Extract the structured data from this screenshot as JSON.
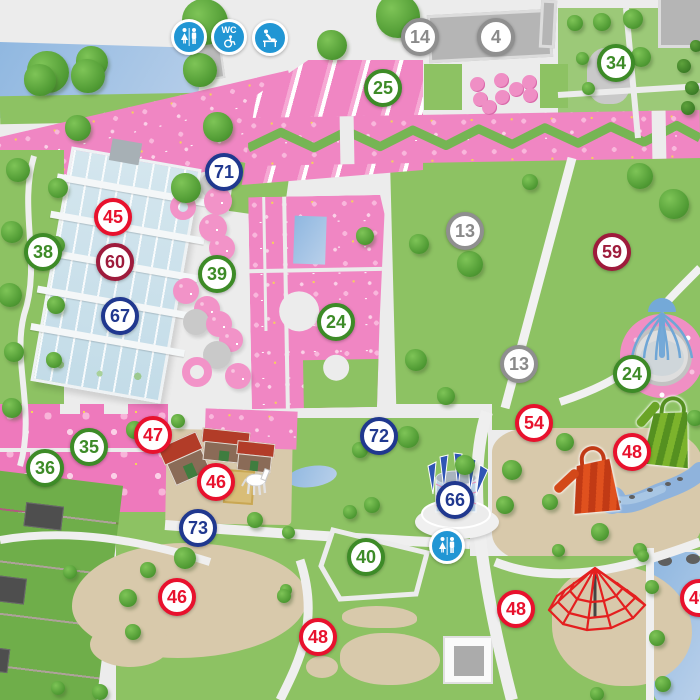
{
  "map": {
    "palette": {
      "path": "#ececec",
      "lawn": "#8dc263",
      "flowerbed": "#f086c3",
      "water": "#8fb7e0",
      "sand": "#d8c9ab",
      "building_gray": "#b5b5b5",
      "greenhouse_glass": "#cfe2eb",
      "marker_green": "#3d8b27",
      "marker_red": "#e8112d",
      "marker_maroon": "#9e1b3c",
      "marker_navy": "#20388f",
      "marker_gray": "#8f8f8f",
      "facility_blue": "#2196d4",
      "zigzag_green": "#76b554",
      "web_red": "#e41f1f"
    },
    "markers": [
      {
        "label": "14",
        "color": "gray",
        "x": 420,
        "y": 37
      },
      {
        "label": "4",
        "color": "gray",
        "x": 496,
        "y": 37
      },
      {
        "label": "34",
        "color": "green",
        "x": 616,
        "y": 63
      },
      {
        "label": "25",
        "color": "green",
        "x": 383,
        "y": 88
      },
      {
        "label": "71",
        "color": "navy",
        "x": 224,
        "y": 172
      },
      {
        "label": "45",
        "color": "red",
        "x": 113,
        "y": 217
      },
      {
        "label": "13",
        "color": "gray",
        "x": 465,
        "y": 231
      },
      {
        "label": "38",
        "color": "green",
        "x": 43,
        "y": 252
      },
      {
        "label": "59",
        "color": "maroon",
        "x": 612,
        "y": 252
      },
      {
        "label": "60",
        "color": "maroon",
        "x": 115,
        "y": 262
      },
      {
        "label": "39",
        "color": "green",
        "x": 217,
        "y": 274
      },
      {
        "label": "67",
        "color": "navy",
        "x": 120,
        "y": 316
      },
      {
        "label": "24",
        "color": "green",
        "x": 336,
        "y": 322
      },
      {
        "label": "13",
        "color": "gray",
        "x": 519,
        "y": 364
      },
      {
        "label": "24",
        "color": "green",
        "x": 632,
        "y": 374
      },
      {
        "label": "54",
        "color": "red",
        "x": 534,
        "y": 423
      },
      {
        "label": "47",
        "color": "red",
        "x": 153,
        "y": 435
      },
      {
        "label": "72",
        "color": "navy",
        "x": 379,
        "y": 436
      },
      {
        "label": "35",
        "color": "green",
        "x": 89,
        "y": 447
      },
      {
        "label": "48",
        "color": "red",
        "x": 632,
        "y": 452
      },
      {
        "label": "36",
        "color": "green",
        "x": 45,
        "y": 468
      },
      {
        "label": "46",
        "color": "red",
        "x": 216,
        "y": 482
      },
      {
        "label": "66",
        "color": "navy",
        "x": 455,
        "y": 500
      },
      {
        "label": "73",
        "color": "navy",
        "x": 198,
        "y": 528
      },
      {
        "label": "40",
        "color": "green",
        "x": 366,
        "y": 557
      },
      {
        "label": "46",
        "color": "red",
        "x": 177,
        "y": 597
      },
      {
        "label": "49",
        "color": "red",
        "x": 699,
        "y": 598
      },
      {
        "label": "48",
        "color": "red",
        "x": 516,
        "y": 609
      },
      {
        "label": "48",
        "color": "red",
        "x": 318,
        "y": 637
      }
    ],
    "facilities": [
      {
        "type": "toilets",
        "name": "toilets-icon",
        "label": "",
        "x": 189,
        "y": 37
      },
      {
        "type": "wc",
        "name": "wc-accessible-icon",
        "label": "WC",
        "x": 229,
        "y": 37
      },
      {
        "type": "baby",
        "name": "baby-changing-icon",
        "label": "",
        "x": 270,
        "y": 38
      },
      {
        "type": "toilets",
        "name": "toilets-icon",
        "label": "",
        "x": 447,
        "y": 546
      }
    ],
    "trees": [
      [
        48,
        72,
        42
      ],
      [
        92,
        62,
        32
      ],
      [
        205,
        22,
        46
      ],
      [
        200,
        70,
        34
      ],
      [
        332,
        45,
        30
      ],
      [
        398,
        16,
        44
      ],
      [
        40,
        80,
        32
      ],
      [
        88,
        76,
        34
      ],
      [
        218,
        127,
        30
      ],
      [
        78,
        128,
        26
      ],
      [
        18,
        170,
        24
      ],
      [
        58,
        188,
        20
      ],
      [
        12,
        232,
        22
      ],
      [
        56,
        245,
        18
      ],
      [
        10,
        295,
        24
      ],
      [
        56,
        305,
        18
      ],
      [
        14,
        352,
        20
      ],
      [
        54,
        360,
        16
      ],
      [
        12,
        408,
        20
      ],
      [
        186,
        188,
        30
      ],
      [
        365,
        236,
        18
      ],
      [
        419,
        244,
        20
      ],
      [
        470,
        264,
        26
      ],
      [
        416,
        360,
        22
      ],
      [
        446,
        396,
        18
      ],
      [
        640,
        176,
        26
      ],
      [
        674,
        204,
        30
      ],
      [
        530,
        182,
        16
      ],
      [
        575,
        23,
        16
      ],
      [
        602,
        22,
        18
      ],
      [
        633,
        19,
        20
      ],
      [
        582,
        58,
        13
      ],
      [
        588,
        88,
        13
      ],
      [
        641,
        57,
        20
      ],
      [
        135,
        430,
        18
      ],
      [
        178,
        421,
        14
      ],
      [
        408,
        437,
        22
      ],
      [
        465,
        465,
        20
      ],
      [
        360,
        450,
        16
      ],
      [
        372,
        505,
        16
      ],
      [
        350,
        512,
        14
      ],
      [
        255,
        520,
        16
      ],
      [
        288,
        532,
        13
      ],
      [
        286,
        590,
        12
      ],
      [
        185,
        558,
        22
      ],
      [
        148,
        570,
        16
      ],
      [
        128,
        598,
        18
      ],
      [
        133,
        632,
        16
      ],
      [
        70,
        572,
        14
      ],
      [
        284,
        596,
        14
      ],
      [
        100,
        692,
        16
      ],
      [
        58,
        688,
        14
      ],
      [
        565,
        442,
        18
      ],
      [
        512,
        470,
        20
      ],
      [
        505,
        505,
        18
      ],
      [
        550,
        502,
        16
      ],
      [
        600,
        532,
        18
      ],
      [
        640,
        550,
        14
      ],
      [
        558,
        550,
        13
      ],
      [
        643,
        556,
        12
      ],
      [
        652,
        587,
        14
      ],
      [
        657,
        638,
        16
      ],
      [
        663,
        684,
        16
      ],
      [
        597,
        694,
        14
      ],
      [
        695,
        418,
        16
      ]
    ],
    "hedges": [
      [
        684,
        66,
        14
      ],
      [
        692,
        88,
        14
      ],
      [
        688,
        108,
        14
      ],
      [
        696,
        46,
        12
      ]
    ],
    "bed_circles": [
      {
        "x": 213,
        "y": 185,
        "d": 26,
        "kind": "gray"
      },
      {
        "x": 218,
        "y": 201,
        "d": 28,
        "kind": "pink"
      },
      {
        "x": 213,
        "y": 228,
        "d": 28,
        "kind": "pink"
      },
      {
        "x": 222,
        "y": 248,
        "d": 26,
        "kind": "pink"
      },
      {
        "x": 183,
        "y": 207,
        "d": 26,
        "kind": "ring"
      },
      {
        "x": 186,
        "y": 291,
        "d": 26,
        "kind": "pink"
      },
      {
        "x": 207,
        "y": 309,
        "d": 26,
        "kind": "pink"
      },
      {
        "x": 196,
        "y": 322,
        "d": 26,
        "kind": "gray"
      },
      {
        "x": 219,
        "y": 324,
        "d": 26,
        "kind": "pink"
      },
      {
        "x": 231,
        "y": 340,
        "d": 24,
        "kind": "pink"
      },
      {
        "x": 217,
        "y": 355,
        "d": 28,
        "kind": "gray"
      },
      {
        "x": 238,
        "y": 376,
        "d": 26,
        "kind": "pink"
      },
      {
        "x": 197,
        "y": 372,
        "d": 30,
        "kind": "ring"
      }
    ],
    "dot_beds": [
      [
        477,
        84
      ],
      [
        501,
        80
      ],
      [
        516,
        89
      ],
      [
        529,
        82
      ],
      [
        480,
        99
      ],
      [
        502,
        97
      ],
      [
        530,
        95
      ],
      [
        489,
        107
      ]
    ]
  }
}
